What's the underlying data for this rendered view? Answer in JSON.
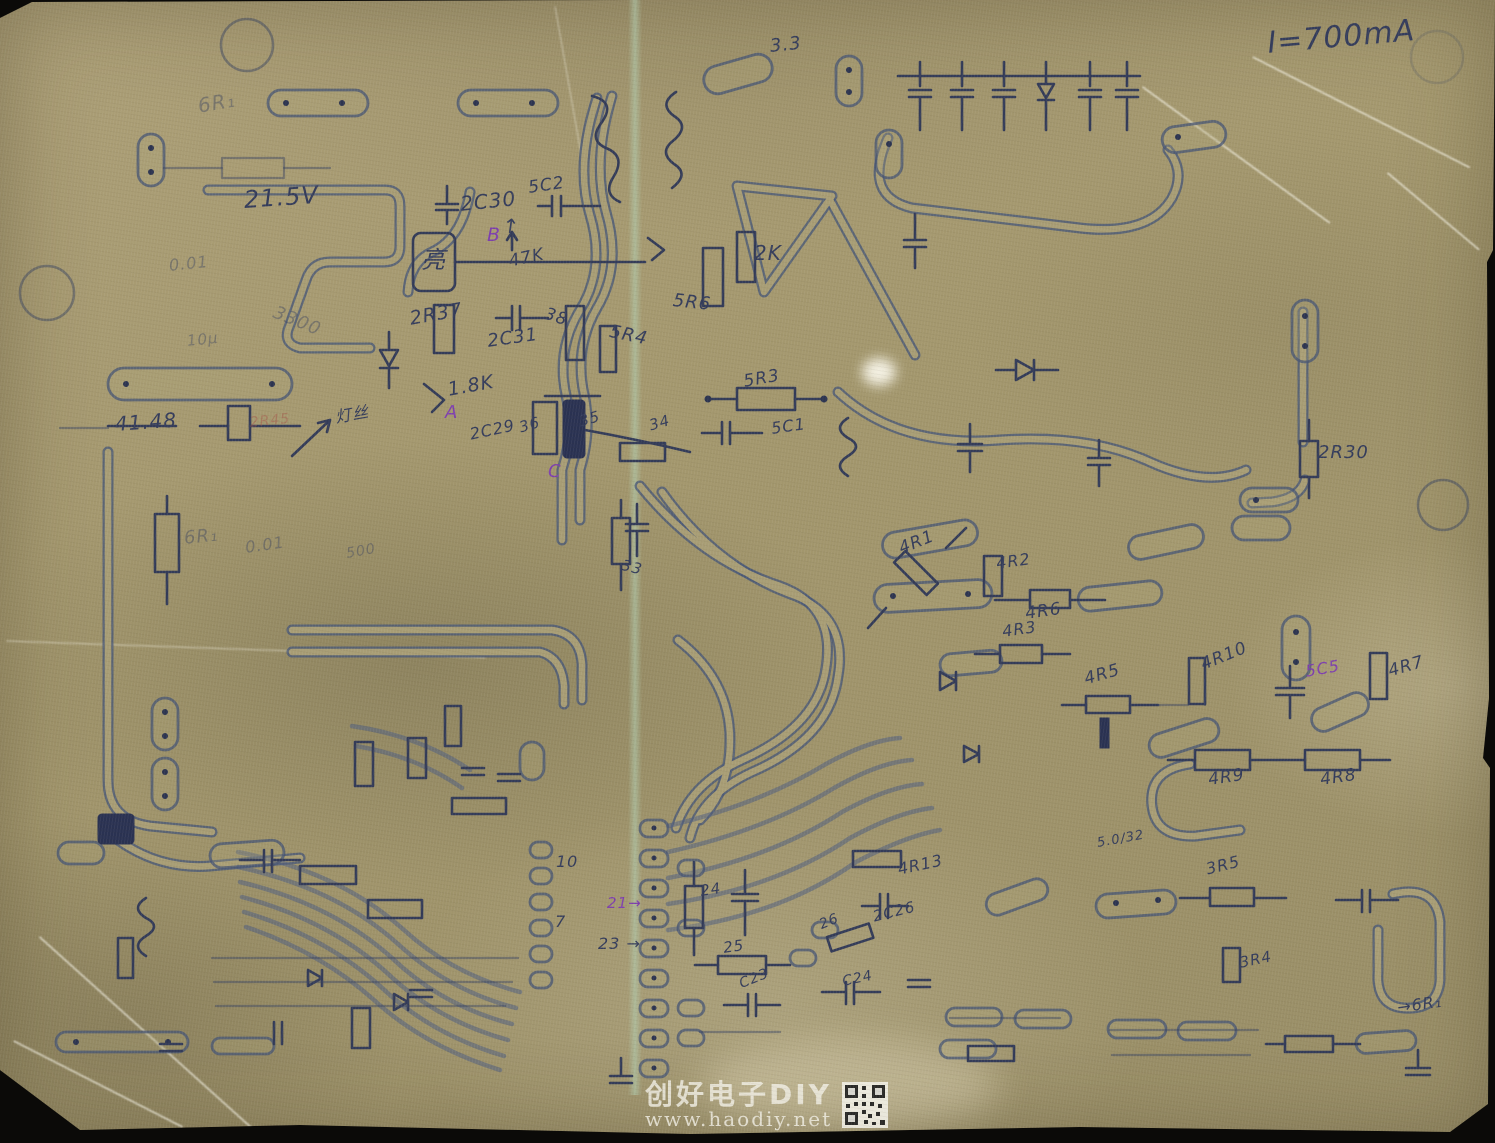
{
  "document": {
    "kind": "hand-drawn circuit board trace layout, scanned on kraft paper",
    "top_annotation": "I=700mA"
  },
  "ink_colors": {
    "d": "#343c5b",
    "p": "#7e3fae",
    "f": "rgba(55,65,95,0.42)",
    "r": "rgba(165,90,75,0.5)"
  },
  "labels": [
    {
      "t": "I=700mA",
      "x": 1266,
      "y": 26,
      "s": 30,
      "r": -5,
      "c": "d"
    },
    {
      "t": "6R₁",
      "x": 196,
      "y": 94,
      "s": 20,
      "r": -10,
      "c": "f"
    },
    {
      "t": "21.5V",
      "x": 243,
      "y": 186,
      "s": 24,
      "r": -4,
      "c": "d"
    },
    {
      "t": "0.01",
      "x": 168,
      "y": 256,
      "s": 16,
      "r": -6,
      "c": "f"
    },
    {
      "t": "3300",
      "x": 278,
      "y": 302,
      "s": 18,
      "r": 22,
      "c": "f"
    },
    {
      "t": "10μ",
      "x": 186,
      "y": 332,
      "s": 15,
      "r": -6,
      "c": "f"
    },
    {
      "t": "2C30",
      "x": 459,
      "y": 192,
      "s": 20,
      "r": -6,
      "c": "d"
    },
    {
      "t": "5C2",
      "x": 527,
      "y": 178,
      "s": 17,
      "r": -8,
      "c": "d"
    },
    {
      "t": "亮",
      "x": 421,
      "y": 240,
      "s": 24,
      "r": 0,
      "c": "d"
    },
    {
      "t": "B",
      "x": 487,
      "y": 224,
      "s": 19,
      "r": 0,
      "c": "p"
    },
    {
      "t": "↑",
      "x": 504,
      "y": 213,
      "s": 20,
      "r": 8,
      "c": "d"
    },
    {
      "t": "47K",
      "x": 507,
      "y": 252,
      "s": 17,
      "r": -12,
      "c": "d"
    },
    {
      "t": "2R37",
      "x": 408,
      "y": 308,
      "s": 19,
      "r": -10,
      "c": "d"
    },
    {
      "t": "2C31",
      "x": 486,
      "y": 331,
      "s": 18,
      "r": -8,
      "c": "d"
    },
    {
      "t": "38",
      "x": 548,
      "y": 304,
      "s": 17,
      "r": 18,
      "c": "d"
    },
    {
      "t": "5R4",
      "x": 612,
      "y": 321,
      "s": 18,
      "r": 12,
      "c": "d"
    },
    {
      "t": "2K",
      "x": 754,
      "y": 241,
      "s": 20,
      "r": 0,
      "c": "d"
    },
    {
      "t": "5R6",
      "x": 674,
      "y": 290,
      "s": 18,
      "r": 6,
      "c": "d"
    },
    {
      "t": "3.3",
      "x": 769,
      "y": 36,
      "s": 18,
      "r": -6,
      "c": "d"
    },
    {
      "t": "1.8K",
      "x": 446,
      "y": 379,
      "s": 19,
      "r": -10,
      "c": "d"
    },
    {
      "t": "A",
      "x": 445,
      "y": 402,
      "s": 18,
      "r": 0,
      "c": "p"
    },
    {
      "t": "2C29",
      "x": 468,
      "y": 425,
      "s": 16,
      "r": -12,
      "c": "d"
    },
    {
      "t": "36",
      "x": 517,
      "y": 419,
      "s": 15,
      "r": -16,
      "c": "d"
    },
    {
      "t": "35",
      "x": 577,
      "y": 413,
      "s": 15,
      "r": -16,
      "c": "d"
    },
    {
      "t": "34",
      "x": 647,
      "y": 417,
      "s": 15,
      "r": -16,
      "c": "d"
    },
    {
      "t": "C",
      "x": 548,
      "y": 461,
      "s": 18,
      "r": 0,
      "c": "p"
    },
    {
      "t": "5R3",
      "x": 742,
      "y": 372,
      "s": 17,
      "r": -10,
      "c": "d"
    },
    {
      "t": "5C1",
      "x": 770,
      "y": 419,
      "s": 16,
      "r": -8,
      "c": "d"
    },
    {
      "t": "41.48",
      "x": 114,
      "y": 412,
      "s": 20,
      "r": -4,
      "c": "d"
    },
    {
      "t": "2R45",
      "x": 249,
      "y": 415,
      "s": 14,
      "r": -6,
      "c": "r"
    },
    {
      "t": "灯丝",
      "x": 333,
      "y": 404,
      "s": 16,
      "r": -10,
      "c": "d"
    },
    {
      "t": "6R₁",
      "x": 183,
      "y": 528,
      "s": 18,
      "r": -6,
      "c": "f"
    },
    {
      "t": "0.01",
      "x": 244,
      "y": 538,
      "s": 16,
      "r": -8,
      "c": "f"
    },
    {
      "t": "500",
      "x": 345,
      "y": 546,
      "s": 14,
      "r": -10,
      "c": "f"
    },
    {
      "t": "33",
      "x": 624,
      "y": 556,
      "s": 15,
      "r": 14,
      "c": "d"
    },
    {
      "t": "2R30",
      "x": 1318,
      "y": 442,
      "s": 18,
      "r": 0,
      "c": "d"
    },
    {
      "t": "4R1",
      "x": 896,
      "y": 540,
      "s": 17,
      "r": -22,
      "c": "d"
    },
    {
      "t": "4R2",
      "x": 995,
      "y": 554,
      "s": 16,
      "r": -8,
      "c": "d"
    },
    {
      "t": "4R6",
      "x": 1024,
      "y": 604,
      "s": 17,
      "r": -8,
      "c": "d"
    },
    {
      "t": "4R3",
      "x": 1001,
      "y": 622,
      "s": 16,
      "r": -8,
      "c": "d"
    },
    {
      "t": "4R5",
      "x": 1082,
      "y": 670,
      "s": 17,
      "r": -16,
      "c": "d"
    },
    {
      "t": "4R10",
      "x": 1198,
      "y": 656,
      "s": 17,
      "r": -22,
      "c": "d"
    },
    {
      "t": "5C5",
      "x": 1304,
      "y": 662,
      "s": 16,
      "r": -10,
      "c": "p"
    },
    {
      "t": "4R7",
      "x": 1386,
      "y": 662,
      "s": 17,
      "r": -16,
      "c": "d"
    },
    {
      "t": "4R9",
      "x": 1207,
      "y": 770,
      "s": 17,
      "r": -8,
      "c": "d"
    },
    {
      "t": "4R8",
      "x": 1319,
      "y": 770,
      "s": 17,
      "r": -8,
      "c": "d"
    },
    {
      "t": "5.0/32",
      "x": 1096,
      "y": 836,
      "s": 13,
      "r": -10,
      "c": "d"
    },
    {
      "t": "4R13",
      "x": 896,
      "y": 860,
      "s": 16,
      "r": -12,
      "c": "d"
    },
    {
      "t": "2C26",
      "x": 871,
      "y": 908,
      "s": 15,
      "r": -14,
      "c": "d"
    },
    {
      "t": "10",
      "x": 556,
      "y": 852,
      "s": 16,
      "r": 0,
      "c": "d"
    },
    {
      "t": "7",
      "x": 555,
      "y": 912,
      "s": 16,
      "r": 0,
      "c": "d"
    },
    {
      "t": "21→",
      "x": 607,
      "y": 894,
      "s": 15,
      "r": 0,
      "c": "p"
    },
    {
      "t": "23 →",
      "x": 598,
      "y": 934,
      "s": 16,
      "r": 0,
      "c": "d"
    },
    {
      "t": "24",
      "x": 699,
      "y": 882,
      "s": 15,
      "r": -8,
      "c": "d"
    },
    {
      "t": "25",
      "x": 722,
      "y": 939,
      "s": 15,
      "r": -8,
      "c": "d"
    },
    {
      "t": "26",
      "x": 817,
      "y": 918,
      "s": 14,
      "r": -22,
      "c": "d"
    },
    {
      "t": "C23",
      "x": 737,
      "y": 977,
      "s": 14,
      "r": -22,
      "c": "d"
    },
    {
      "t": "C24",
      "x": 841,
      "y": 974,
      "s": 14,
      "r": -12,
      "c": "d"
    },
    {
      "t": "3R5",
      "x": 1204,
      "y": 860,
      "s": 16,
      "r": -14,
      "c": "d"
    },
    {
      "t": "3R4",
      "x": 1238,
      "y": 954,
      "s": 15,
      "r": -12,
      "c": "d"
    },
    {
      "t": "→6R₁",
      "x": 1396,
      "y": 998,
      "s": 16,
      "r": -8,
      "c": "d"
    }
  ],
  "watermark": {
    "title": "创好电子DIY",
    "url": "www.haodiy.net"
  }
}
